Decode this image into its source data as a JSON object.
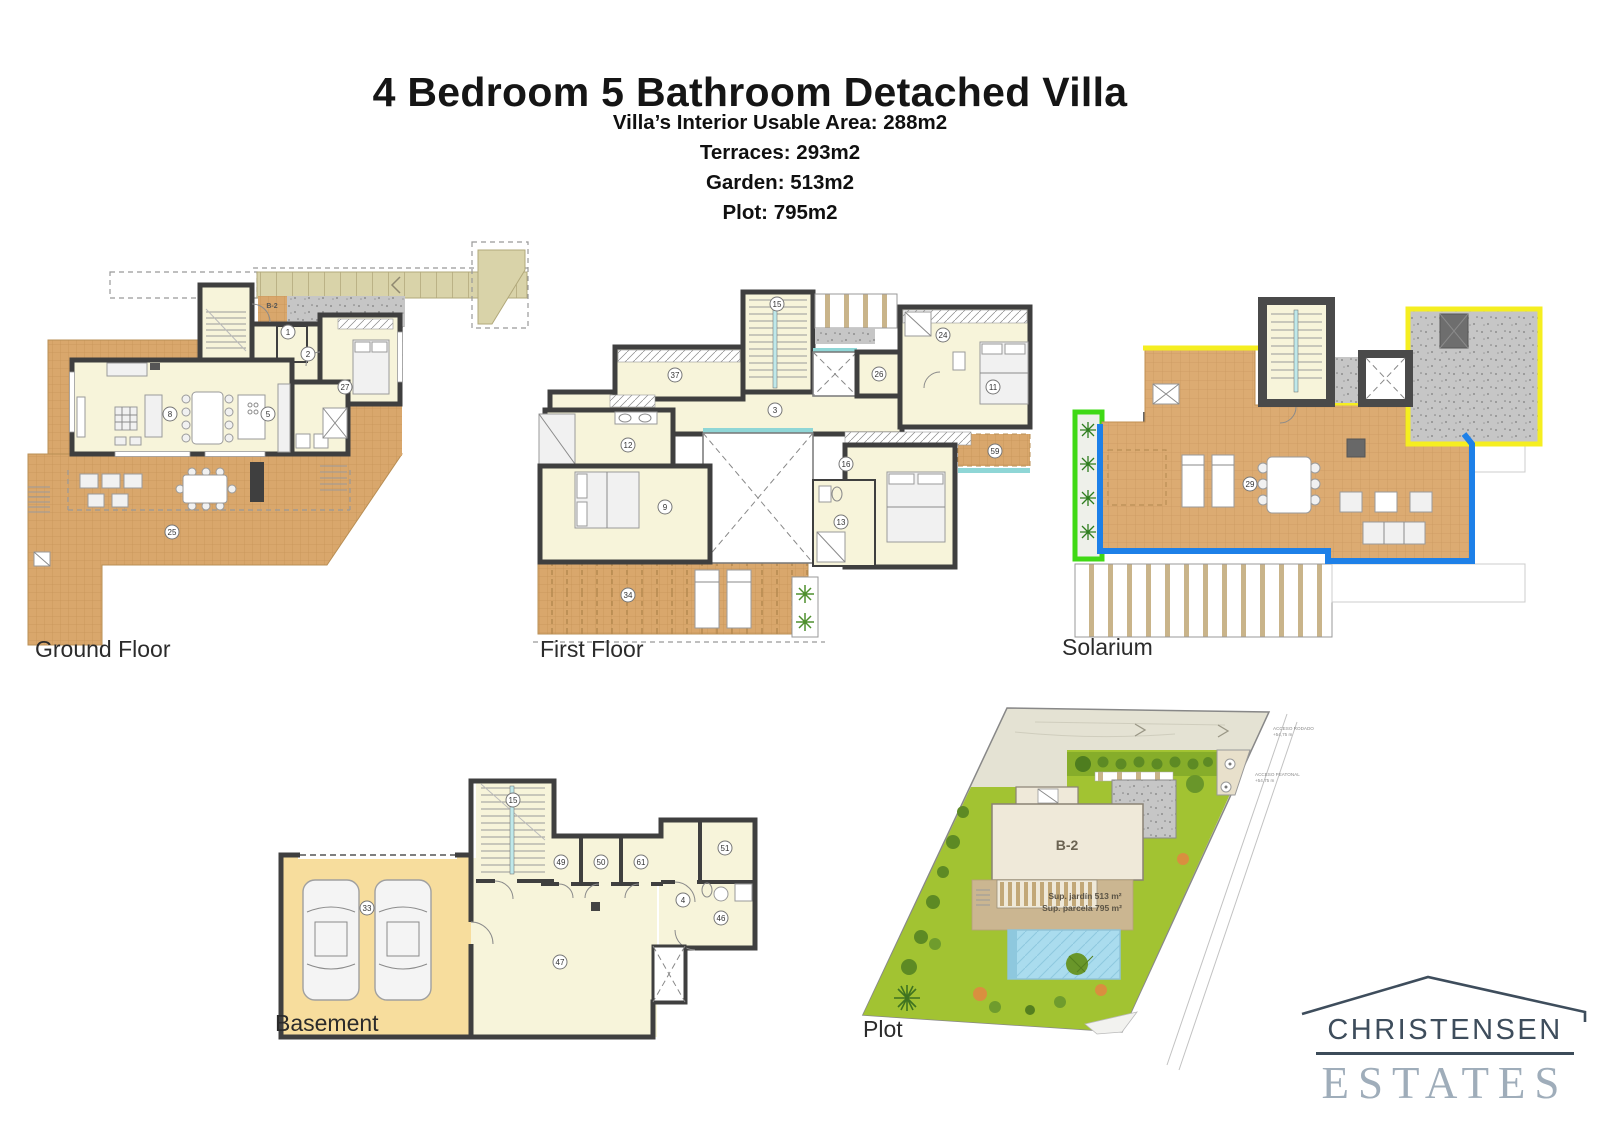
{
  "header": {
    "title": "4 Bedroom 5 Bathroom Detached Villa",
    "stats": [
      "Villa’s Interior Usable Area: 288m2",
      "Terraces: 293m2",
      "Garden: 513m2",
      "Plot: 795m2"
    ]
  },
  "plans": {
    "ground_floor": {
      "label": "Ground Floor",
      "unit_tag": "B-2",
      "rooms": [
        "1",
        "2",
        "27",
        "8",
        "5",
        "25"
      ]
    },
    "first_floor": {
      "label": "First Floor",
      "rooms": [
        "15",
        "37",
        "26",
        "3",
        "24",
        "11",
        "12",
        "9",
        "16",
        "13",
        "34",
        "59"
      ]
    },
    "solarium": {
      "label": "Solarium",
      "rooms": [
        "29"
      ]
    },
    "basement": {
      "label": "Basement",
      "rooms": [
        "15",
        "33",
        "49",
        "50",
        "61",
        "51",
        "4",
        "46",
        "47"
      ]
    },
    "plot": {
      "label": "Plot",
      "unit_tag": "B-2",
      "garden_area": "Sup. jardín 513 m²",
      "plot_area": "Sup. parcela 795 m²",
      "access_road": "ACCESO RODADO",
      "access_road_level": "+54,75 m",
      "access_pedestrian": "ACCESO PEATONAL",
      "access_pedestrian_level": "+54,75 m"
    }
  },
  "logo": {
    "name": "CHRISTENSEN",
    "type": "ESTATES"
  },
  "colors": {
    "wall": "#3f3f3f",
    "interior": "#f7f4da",
    "terrace_tile": "#d9a76c",
    "garage_floor": "#f7dd9d",
    "driveway": "#d9d3a9",
    "gravel": "#c6c6c6",
    "solarium_yellow": "#f5ee20",
    "solarium_blue": "#1d80e8",
    "solarium_green": "#3fd915",
    "garden_green": "#a2c332",
    "pool_blue": "#aadcee",
    "logo_dark": "#3e4d5c",
    "logo_light": "#9fadba"
  }
}
